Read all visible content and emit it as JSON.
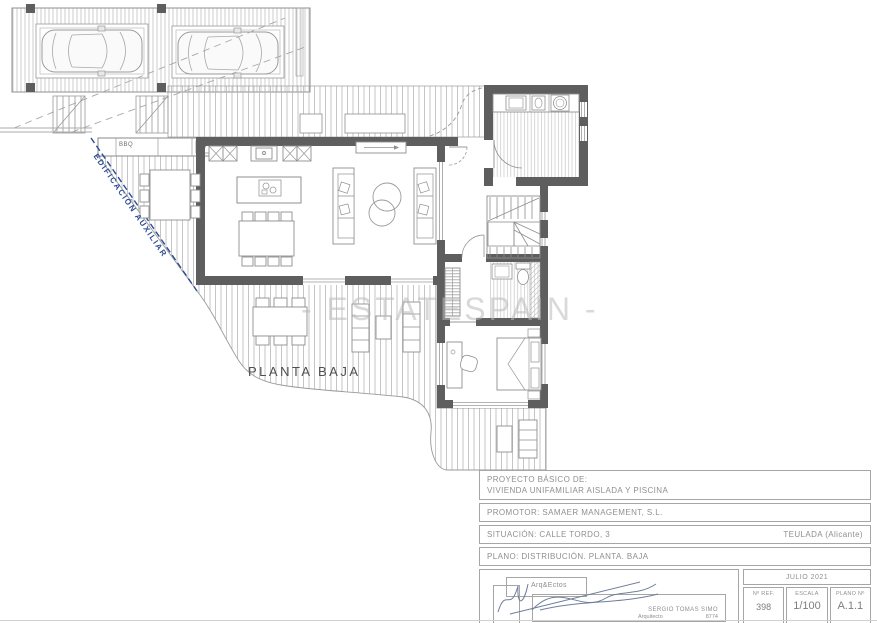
{
  "plan": {
    "floor_label": "PLANTA BAJA",
    "auxiliary_label": "EDIFICACIÓN AUXILIAR",
    "bbq_label": "BBQ",
    "watermark": "- ESTATESPAIN -"
  },
  "title_block": {
    "project_label": "PROYECTO BÁSICO DE:",
    "project_name": "VIVIENDA UNIFAMILIAR AISLADA Y PISCINA",
    "promoter": "PROMOTOR: SAMAER MANAGEMENT, S.L.",
    "situation": "SITUACIÓN: CALLE TORDO, 3",
    "location": "TEULADA (Alicante)",
    "plan_line": "PLANO: DISTRIBUCIÓN. PLANTA. BAJA",
    "firm": "Arq&Ectos",
    "architect_name": "SERGIO TOMAS SIMO",
    "architect_title": "Arquitecto",
    "architect_number": "8774",
    "date": "JULIO 2021",
    "ref_label": "Nº REF.",
    "ref_value": "398",
    "scale_label": "ESCALA",
    "scale_value": "1/100",
    "sheet_label": "PLANO Nº",
    "sheet_value": "A.1.1"
  },
  "colors": {
    "accent_blue": "#2b4c97",
    "wall_gray": "#5e5e5e",
    "line_gray": "#9a9a9a",
    "hatch_gray": "#bdbdbd",
    "watermark_gray": "#d2d2d2",
    "text_gray": "#8f8f8f"
  }
}
